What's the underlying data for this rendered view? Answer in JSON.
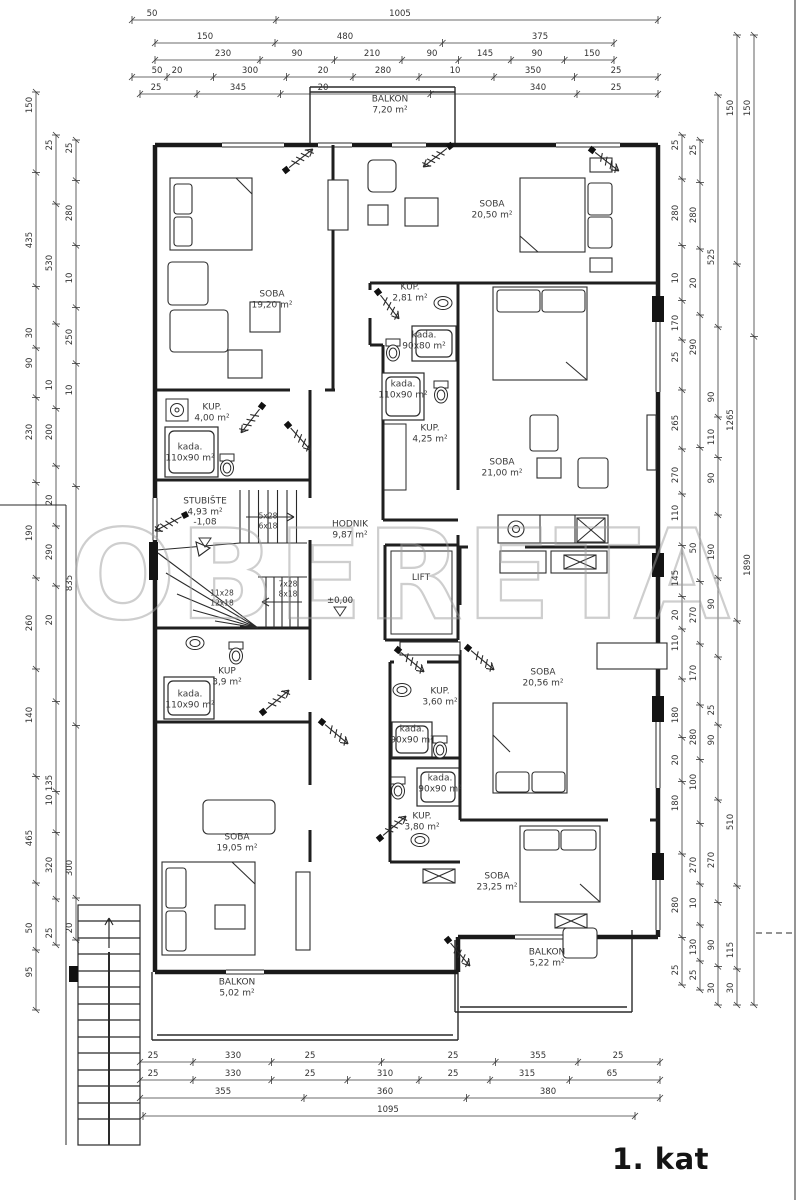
{
  "meta": {
    "floor_label": "1. kat",
    "watermark": "OBERETA"
  },
  "room_labels": [
    {
      "name": "BALKON",
      "area": "7,20 m²",
      "x": 390,
      "y": 105
    },
    {
      "name": "SOBA",
      "area": "20,50 m²",
      "x": 492,
      "y": 210
    },
    {
      "name": "SOBA",
      "area": "19,20 m²",
      "x": 272,
      "y": 300
    },
    {
      "name": "KUP.",
      "area": "2,81 m²",
      "x": 410,
      "y": 293
    },
    {
      "name": "kada.",
      "area": "90x80 m²",
      "x": 424,
      "y": 341
    },
    {
      "name": "kada.",
      "area": "110x90 m²",
      "x": 403,
      "y": 390
    },
    {
      "name": "KUP.",
      "area": "4,25 m²",
      "x": 430,
      "y": 434
    },
    {
      "name": "SOBA",
      "area": "21,00 m²",
      "x": 502,
      "y": 468
    },
    {
      "name": "KUP.",
      "area": "4,00 m²",
      "x": 212,
      "y": 413
    },
    {
      "name": "kada.",
      "area": "110x90 m²",
      "x": 190,
      "y": 453
    },
    {
      "name": "STUBIŠTE",
      "area": "4,93 m²",
      "extra": "-1,08",
      "x": 205,
      "y": 512
    },
    {
      "name": "HODNIK",
      "area": "9,87 m²",
      "x": 350,
      "y": 530
    },
    {
      "name": "LIFT",
      "area": "",
      "x": 421,
      "y": 578
    },
    {
      "name": "KUP",
      "area": "3,9 m²",
      "x": 227,
      "y": 677
    },
    {
      "name": "kada.",
      "area": "110x90 m²",
      "x": 190,
      "y": 700
    },
    {
      "name": "KUP.",
      "area": "3,60 m²",
      "x": 440,
      "y": 697
    },
    {
      "name": "kada.",
      "area": "90x90 m²",
      "x": 412,
      "y": 735
    },
    {
      "name": "kada.",
      "area": "90x90 m²",
      "x": 440,
      "y": 784
    },
    {
      "name": "KUP.",
      "area": "3,80 m²",
      "x": 422,
      "y": 822
    },
    {
      "name": "SOBA",
      "area": "20,56 m²",
      "x": 543,
      "y": 678
    },
    {
      "name": "SOBA",
      "area": "19,05 m²",
      "x": 237,
      "y": 843
    },
    {
      "name": "SOBA",
      "area": "23,25 m²",
      "x": 497,
      "y": 882
    },
    {
      "name": "BALKON",
      "area": "5,22 m²",
      "x": 547,
      "y": 958
    },
    {
      "name": "BALKON",
      "area": "5,02 m²",
      "x": 237,
      "y": 988
    }
  ],
  "stair_notes": [
    {
      "t": "5x28",
      "x": 268,
      "y": 516
    },
    {
      "t": "6x18",
      "x": 268,
      "y": 526
    },
    {
      "t": "7x28",
      "x": 288,
      "y": 584
    },
    {
      "t": "8x18",
      "x": 288,
      "y": 594
    },
    {
      "t": "11x28",
      "x": 222,
      "y": 593
    },
    {
      "t": "12x18",
      "x": 222,
      "y": 603
    }
  ],
  "level_marks": [
    {
      "t": "±0,00",
      "x": 340,
      "y": 601
    }
  ],
  "dim_labels": [
    {
      "t": "50",
      "x": 152,
      "y": 14,
      "v": 0
    },
    {
      "t": "1005",
      "x": 400,
      "y": 14,
      "v": 0
    },
    {
      "t": "150",
      "x": 205,
      "y": 37,
      "v": 0
    },
    {
      "t": "480",
      "x": 345,
      "y": 37,
      "v": 0
    },
    {
      "t": "375",
      "x": 540,
      "y": 37,
      "v": 0
    },
    {
      "t": "230",
      "x": 223,
      "y": 54,
      "v": 0
    },
    {
      "t": "90",
      "x": 297,
      "y": 54,
      "v": 0
    },
    {
      "t": "210",
      "x": 372,
      "y": 54,
      "v": 0
    },
    {
      "t": "90",
      "x": 432,
      "y": 54,
      "v": 0
    },
    {
      "t": "145",
      "x": 485,
      "y": 54,
      "v": 0
    },
    {
      "t": "90",
      "x": 537,
      "y": 54,
      "v": 0
    },
    {
      "t": "150",
      "x": 592,
      "y": 54,
      "v": 0
    },
    {
      "t": "50",
      "x": 157,
      "y": 71,
      "v": 0
    },
    {
      "t": "20",
      "x": 177,
      "y": 71,
      "v": 0
    },
    {
      "t": "300",
      "x": 250,
      "y": 71,
      "v": 0
    },
    {
      "t": "20",
      "x": 323,
      "y": 71,
      "v": 0
    },
    {
      "t": "280",
      "x": 383,
      "y": 71,
      "v": 0
    },
    {
      "t": "10",
      "x": 455,
      "y": 71,
      "v": 0
    },
    {
      "t": "350",
      "x": 533,
      "y": 71,
      "v": 0
    },
    {
      "t": "25",
      "x": 616,
      "y": 71,
      "v": 0
    },
    {
      "t": "25",
      "x": 156,
      "y": 88,
      "v": 0
    },
    {
      "t": "345",
      "x": 238,
      "y": 88,
      "v": 0
    },
    {
      "t": "20",
      "x": 323,
      "y": 88,
      "v": 0
    },
    {
      "t": "340",
      "x": 538,
      "y": 88,
      "v": 0
    },
    {
      "t": "25",
      "x": 616,
      "y": 88,
      "v": 0
    },
    {
      "t": "25",
      "x": 153,
      "y": 1056,
      "v": 0
    },
    {
      "t": "330",
      "x": 233,
      "y": 1056,
      "v": 0
    },
    {
      "t": "25",
      "x": 310,
      "y": 1056,
      "v": 0
    },
    {
      "t": "25",
      "x": 453,
      "y": 1056,
      "v": 0
    },
    {
      "t": "355",
      "x": 538,
      "y": 1056,
      "v": 0
    },
    {
      "t": "25",
      "x": 618,
      "y": 1056,
      "v": 0
    },
    {
      "t": "25",
      "x": 153,
      "y": 1074,
      "v": 0
    },
    {
      "t": "330",
      "x": 233,
      "y": 1074,
      "v": 0
    },
    {
      "t": "25",
      "x": 310,
      "y": 1074,
      "v": 0
    },
    {
      "t": "310",
      "x": 385,
      "y": 1074,
      "v": 0
    },
    {
      "t": "25",
      "x": 453,
      "y": 1074,
      "v": 0
    },
    {
      "t": "315",
      "x": 527,
      "y": 1074,
      "v": 0
    },
    {
      "t": "65",
      "x": 612,
      "y": 1074,
      "v": 0
    },
    {
      "t": "355",
      "x": 223,
      "y": 1092,
      "v": 0
    },
    {
      "t": "360",
      "x": 385,
      "y": 1092,
      "v": 0
    },
    {
      "t": "380",
      "x": 548,
      "y": 1092,
      "v": 0
    },
    {
      "t": "1095",
      "x": 388,
      "y": 1110,
      "v": 0
    },
    {
      "t": "150",
      "x": 30,
      "y": 105,
      "v": 1
    },
    {
      "t": "435",
      "x": 30,
      "y": 240,
      "v": 1
    },
    {
      "t": "30",
      "x": 30,
      "y": 333,
      "v": 1
    },
    {
      "t": "90",
      "x": 30,
      "y": 363,
      "v": 1
    },
    {
      "t": "230",
      "x": 30,
      "y": 432,
      "v": 1
    },
    {
      "t": "190",
      "x": 30,
      "y": 533,
      "v": 1
    },
    {
      "t": "260",
      "x": 30,
      "y": 623,
      "v": 1
    },
    {
      "t": "140",
      "x": 30,
      "y": 715,
      "v": 1
    },
    {
      "t": "465",
      "x": 30,
      "y": 838,
      "v": 1
    },
    {
      "t": "50",
      "x": 30,
      "y": 928,
      "v": 1
    },
    {
      "t": "95",
      "x": 30,
      "y": 972,
      "v": 1
    },
    {
      "t": "25",
      "x": 50,
      "y": 145,
      "v": 1
    },
    {
      "t": "530",
      "x": 50,
      "y": 263,
      "v": 1
    },
    {
      "t": "10",
      "x": 50,
      "y": 385,
      "v": 1
    },
    {
      "t": "200",
      "x": 50,
      "y": 432,
      "v": 1
    },
    {
      "t": "20",
      "x": 50,
      "y": 500,
      "v": 1
    },
    {
      "t": "290",
      "x": 50,
      "y": 552,
      "v": 1
    },
    {
      "t": "20",
      "x": 50,
      "y": 620,
      "v": 1
    },
    {
      "t": "135",
      "x": 50,
      "y": 783,
      "v": 1
    },
    {
      "t": "10",
      "x": 50,
      "y": 800,
      "v": 1
    },
    {
      "t": "320",
      "x": 50,
      "y": 865,
      "v": 1
    },
    {
      "t": "25",
      "x": 50,
      "y": 933,
      "v": 1
    },
    {
      "t": "25",
      "x": 70,
      "y": 148,
      "v": 1
    },
    {
      "t": "280",
      "x": 70,
      "y": 213,
      "v": 1
    },
    {
      "t": "10",
      "x": 70,
      "y": 278,
      "v": 1
    },
    {
      "t": "250",
      "x": 70,
      "y": 337,
      "v": 1
    },
    {
      "t": "10",
      "x": 70,
      "y": 390,
      "v": 1
    },
    {
      "t": "835",
      "x": 70,
      "y": 583,
      "v": 1
    },
    {
      "t": "300",
      "x": 70,
      "y": 868,
      "v": 1
    },
    {
      "t": "20",
      "x": 70,
      "y": 928,
      "v": 1
    },
    {
      "t": "25",
      "x": 676,
      "y": 145,
      "v": 1
    },
    {
      "t": "280",
      "x": 676,
      "y": 213,
      "v": 1
    },
    {
      "t": "10",
      "x": 676,
      "y": 278,
      "v": 1
    },
    {
      "t": "170",
      "x": 676,
      "y": 323,
      "v": 1
    },
    {
      "t": "25",
      "x": 676,
      "y": 357,
      "v": 1
    },
    {
      "t": "265",
      "x": 676,
      "y": 423,
      "v": 1
    },
    {
      "t": "270",
      "x": 676,
      "y": 475,
      "v": 1
    },
    {
      "t": "110",
      "x": 676,
      "y": 513,
      "v": 1
    },
    {
      "t": "145",
      "x": 676,
      "y": 578,
      "v": 1
    },
    {
      "t": "20",
      "x": 676,
      "y": 615,
      "v": 1
    },
    {
      "t": "110",
      "x": 676,
      "y": 643,
      "v": 1
    },
    {
      "t": "180",
      "x": 676,
      "y": 715,
      "v": 1
    },
    {
      "t": "20",
      "x": 676,
      "y": 760,
      "v": 1
    },
    {
      "t": "180",
      "x": 676,
      "y": 803,
      "v": 1
    },
    {
      "t": "280",
      "x": 676,
      "y": 905,
      "v": 1
    },
    {
      "t": "25",
      "x": 676,
      "y": 970,
      "v": 1
    },
    {
      "t": "25",
      "x": 694,
      "y": 150,
      "v": 1
    },
    {
      "t": "280",
      "x": 694,
      "y": 215,
      "v": 1
    },
    {
      "t": "20",
      "x": 694,
      "y": 283,
      "v": 1
    },
    {
      "t": "290",
      "x": 694,
      "y": 347,
      "v": 1
    },
    {
      "t": "50",
      "x": 694,
      "y": 548,
      "v": 1
    },
    {
      "t": "270",
      "x": 694,
      "y": 615,
      "v": 1
    },
    {
      "t": "170",
      "x": 694,
      "y": 673,
      "v": 1
    },
    {
      "t": "280",
      "x": 694,
      "y": 737,
      "v": 1
    },
    {
      "t": "100",
      "x": 694,
      "y": 782,
      "v": 1
    },
    {
      "t": "270",
      "x": 694,
      "y": 865,
      "v": 1
    },
    {
      "t": "10",
      "x": 694,
      "y": 903,
      "v": 1
    },
    {
      "t": "130",
      "x": 694,
      "y": 947,
      "v": 1
    },
    {
      "t": "25",
      "x": 694,
      "y": 975,
      "v": 1
    },
    {
      "t": "525",
      "x": 712,
      "y": 257,
      "v": 1
    },
    {
      "t": "90",
      "x": 712,
      "y": 397,
      "v": 1
    },
    {
      "t": "110",
      "x": 712,
      "y": 437,
      "v": 1
    },
    {
      "t": "90",
      "x": 712,
      "y": 478,
      "v": 1
    },
    {
      "t": "190",
      "x": 712,
      "y": 552,
      "v": 1
    },
    {
      "t": "90",
      "x": 712,
      "y": 604,
      "v": 1
    },
    {
      "t": "25",
      "x": 712,
      "y": 710,
      "v": 1
    },
    {
      "t": "90",
      "x": 712,
      "y": 740,
      "v": 1
    },
    {
      "t": "270",
      "x": 712,
      "y": 860,
      "v": 1
    },
    {
      "t": "90",
      "x": 712,
      "y": 945,
      "v": 1
    },
    {
      "t": "30",
      "x": 712,
      "y": 988,
      "v": 1
    },
    {
      "t": "150",
      "x": 731,
      "y": 108,
      "v": 1
    },
    {
      "t": "1265",
      "x": 731,
      "y": 420,
      "v": 1
    },
    {
      "t": "510",
      "x": 731,
      "y": 822,
      "v": 1
    },
    {
      "t": "115",
      "x": 731,
      "y": 950,
      "v": 1
    },
    {
      "t": "30",
      "x": 731,
      "y": 988,
      "v": 1
    },
    {
      "t": "150",
      "x": 748,
      "y": 108,
      "v": 1
    },
    {
      "t": "1890",
      "x": 748,
      "y": 565,
      "v": 1
    }
  ]
}
